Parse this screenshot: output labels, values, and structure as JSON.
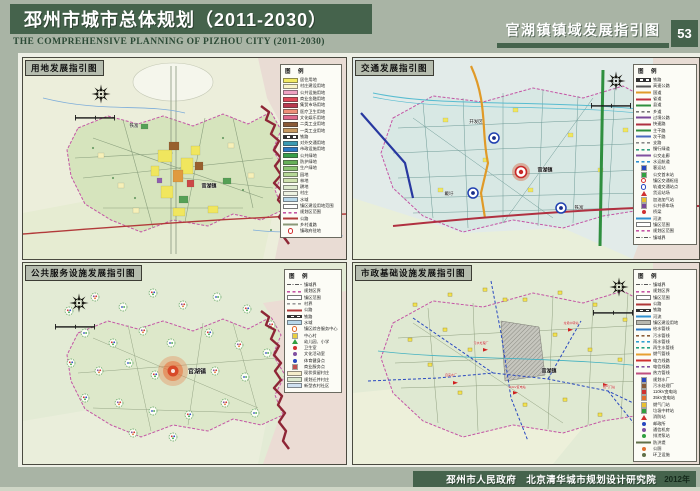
{
  "header": {
    "title_cn": "邳州市城市总体规划（2011-2030）",
    "title_en": "THE  COMPREHENSIVE PLANNING OF PIZHOU CITY  (2011-2030)",
    "sheet_title": "官湖镇镇域发展指引图",
    "page_number": "53"
  },
  "footer": {
    "text": "邳州市人民政府　北京清华城市规划设计研究院",
    "year": "2012年"
  },
  "legend_title": "图 例",
  "colors": {
    "header_green": "#45634c",
    "page_bg": "#a9b4a5",
    "boundary_dark_red": "#8e2636",
    "planning_area_magenta": "#c455a5"
  },
  "panels": [
    {
      "id": "landuse",
      "title": "用地发展指引图",
      "map_labels": [
        {
          "text": "铁富",
          "x": 111,
          "y": 68,
          "size": 4.5
        },
        {
          "text": "官湖镇",
          "x": 186,
          "y": 128,
          "size": 5,
          "bold": true
        }
      ],
      "legend": [
        {
          "type": "fill",
          "color": "#f2ea62",
          "label": "居住用地"
        },
        {
          "type": "fill",
          "color": "#f8f3c6",
          "label": "村庄建设用地"
        },
        {
          "type": "fill",
          "color": "#f0a2c2",
          "label": "公共设施用地"
        },
        {
          "type": "fill",
          "color": "#e04858",
          "label": "商业金融用地"
        },
        {
          "type": "fill",
          "color": "#b93a4e",
          "label": "集贸市场用地"
        },
        {
          "type": "fill",
          "color": "#f09078",
          "label": "医疗卫生用地"
        },
        {
          "type": "fill",
          "color": "#e06a8c",
          "label": "文化娱乐用地"
        },
        {
          "type": "fill",
          "color": "#8a5a36",
          "label": "二类工业用地"
        },
        {
          "type": "fill",
          "color": "#c79a60",
          "label": "一类工业用地"
        },
        {
          "type": "rail",
          "color": "#3a52a8",
          "label": "铁路"
        },
        {
          "type": "fill",
          "color": "#3a9ab2",
          "label": "对外交通用地"
        },
        {
          "type": "fill",
          "color": "#2a78c4",
          "label": "市政设施用地"
        },
        {
          "type": "fill",
          "color": "#389e48",
          "label": "公共绿地"
        },
        {
          "type": "fill",
          "color": "#66b058",
          "label": "防护绿地"
        },
        {
          "type": "fill",
          "color": "#8cc472",
          "label": "生产绿地"
        },
        {
          "type": "fill",
          "color": "#b6d896",
          "label": "园地"
        },
        {
          "type": "fill",
          "color": "#cfe2ae",
          "label": "林地"
        },
        {
          "type": "fill",
          "color": "#deeace",
          "label": "耕地"
        },
        {
          "type": "fill",
          "color": "#eef2e2",
          "label": "村庄"
        },
        {
          "type": "fill",
          "color": "#b8d8ea",
          "label": "水域"
        },
        {
          "type": "outline",
          "color": "#777777",
          "label": "镇区建设用地范围"
        },
        {
          "type": "dash",
          "color": "#c455a5",
          "label": "规划区范围"
        },
        {
          "type": "line",
          "color": "#b03838",
          "label": "公路"
        },
        {
          "type": "line",
          "color": "#8a9878",
          "label": "乡村道路"
        },
        {
          "type": "ring",
          "color": "#d03030",
          "label": "镇政府驻地"
        }
      ]
    },
    {
      "id": "traffic",
      "title": "交通发展指引图",
      "map_labels": [
        {
          "text": "开发区",
          "x": 123,
          "y": 64,
          "size": 4.5
        },
        {
          "text": "官湖镇",
          "x": 192,
          "y": 112,
          "size": 5,
          "bold": true
        },
        {
          "text": "戴圩",
          "x": 96,
          "y": 136,
          "size": 4.5
        },
        {
          "text": "铁富",
          "x": 226,
          "y": 150,
          "size": 4.5
        }
      ],
      "legend": [
        {
          "type": "rail",
          "color": "#333333",
          "label": "铁路"
        },
        {
          "type": "line",
          "color": "#555555",
          "label": "高速公路"
        },
        {
          "type": "line",
          "color": "#e09a28",
          "label": "国道"
        },
        {
          "type": "line",
          "color": "#c03040",
          "label": "省道"
        },
        {
          "type": "line",
          "color": "#2f8f3f",
          "label": "县道"
        },
        {
          "type": "dash",
          "color": "#777777",
          "label": "乡道"
        },
        {
          "type": "line",
          "color": "#7a4898",
          "label": "过境公路"
        },
        {
          "type": "line",
          "color": "#b03040",
          "label": "快速路"
        },
        {
          "type": "line",
          "color": "#2f8f3f",
          "label": "主干路"
        },
        {
          "type": "line",
          "color": "#4a6ac0",
          "label": "次干路"
        },
        {
          "type": "dash",
          "color": "#888888",
          "label": "支路"
        },
        {
          "type": "dash",
          "color": "#30a080",
          "label": "慢行绿道"
        },
        {
          "type": "line",
          "color": "#8050a0",
          "label": "公交走廊"
        },
        {
          "type": "dash",
          "color": "#3090d0",
          "label": "水运航道"
        },
        {
          "type": "sq",
          "color": "#2848c0",
          "label": "客运站"
        },
        {
          "type": "sq",
          "color": "#30a040",
          "label": "公交首末站"
        },
        {
          "type": "ring",
          "color": "#d03030",
          "label": "镇区交通枢纽"
        },
        {
          "type": "ring",
          "color": "#2848c0",
          "label": "轨道交通站点"
        },
        {
          "type": "tri",
          "color": "#d03030",
          "label": "货运站场"
        },
        {
          "type": "sq",
          "color": "#e8c030",
          "label": "加油加气站"
        },
        {
          "type": "sq",
          "color": "#7a4898",
          "label": "公共停车场"
        },
        {
          "type": "dot",
          "color": "#d03030",
          "label": "桥梁"
        },
        {
          "type": "line",
          "color": "#3090d0",
          "label": "河流"
        },
        {
          "type": "outline",
          "color": "#777777",
          "label": "镇区范围"
        },
        {
          "type": "dash",
          "color": "#c455a5",
          "label": "规划区范围"
        },
        {
          "type": "dashdot",
          "color": "#555555",
          "label": "镇域界"
        }
      ]
    },
    {
      "id": "public-services",
      "title": "公共服务设施发展指引图",
      "map_labels": [
        {
          "text": "官湖镇",
          "x": 174,
          "y": 108,
          "size": 6,
          "bold": true
        }
      ],
      "legend": [
        {
          "type": "dashdot",
          "color": "#555555",
          "label": "镇域界"
        },
        {
          "type": "dash",
          "color": "#c455a5",
          "label": "规划区界"
        },
        {
          "type": "outline",
          "color": "#777777",
          "label": "镇区范围"
        },
        {
          "type": "dash",
          "color": "#999999",
          "label": "村界"
        },
        {
          "type": "line",
          "color": "#b03838",
          "label": "公路"
        },
        {
          "type": "rail",
          "color": "#333333",
          "label": "铁路"
        },
        {
          "type": "fill",
          "color": "#b8d8ea",
          "label": "水域"
        },
        {
          "type": "ring",
          "color": "#e06828",
          "label": "镇区综合服务中心"
        },
        {
          "type": "sq",
          "color": "#e8d040",
          "label": "中心村"
        },
        {
          "type": "tri",
          "color": "#30a040",
          "label": "幼儿园、小学"
        },
        {
          "type": "dot",
          "color": "#d03030",
          "label": "卫生室"
        },
        {
          "type": "dot",
          "color": "#8050a0",
          "label": "文化活动室"
        },
        {
          "type": "dot",
          "color": "#2848c0",
          "label": "体育健身点"
        },
        {
          "type": "sq",
          "color": "#c05050",
          "label": "商业服务点"
        },
        {
          "type": "fill",
          "color": "#f5eecb",
          "label": "现状保留村庄"
        },
        {
          "type": "fill",
          "color": "#dcead0",
          "label": "规划迁并村庄"
        },
        {
          "type": "fill",
          "color": "#cfe0f0",
          "label": "新型农村社区"
        }
      ]
    },
    {
      "id": "municipal",
      "title": "市政基础设施发展指引图",
      "map_labels": [
        {
          "text": "官湖镇",
          "x": 196,
          "y": 108,
          "size": 5,
          "bold": true
        },
        {
          "text": "污水处理厂",
          "x": 128,
          "y": 80,
          "size": 3,
          "color": "#c02020"
        },
        {
          "text": "自来水厂",
          "x": 98,
          "y": 112,
          "size": 3,
          "color": "#c02020"
        },
        {
          "text": "110kV变电站",
          "x": 164,
          "y": 124,
          "size": 3,
          "color": "#c02020"
        },
        {
          "text": "垃圾中转站",
          "x": 218,
          "y": 60,
          "size": 3,
          "color": "#c02020"
        },
        {
          "text": "燃气门站",
          "x": 256,
          "y": 124,
          "size": 3,
          "color": "#c02020"
        }
      ],
      "legend": [
        {
          "type": "dashdot",
          "color": "#555555",
          "label": "镇域界"
        },
        {
          "type": "dash",
          "color": "#c455a5",
          "label": "规划区界"
        },
        {
          "type": "outline",
          "color": "#777777",
          "label": "镇区范围"
        },
        {
          "type": "line",
          "color": "#b03838",
          "label": "公路"
        },
        {
          "type": "rail",
          "color": "#333333",
          "label": "铁路"
        },
        {
          "type": "line",
          "color": "#3090d0",
          "label": "河流"
        },
        {
          "type": "fill",
          "color": "#b8b8b0",
          "label": "镇区建设用地"
        },
        {
          "type": "line",
          "color": "#2a78c4",
          "label": "给水管线"
        },
        {
          "type": "dash",
          "color": "#8a5c38",
          "label": "污水管线"
        },
        {
          "type": "dash",
          "color": "#30a0d0",
          "label": "雨水管线"
        },
        {
          "type": "dash",
          "color": "#20a080",
          "label": "再生水管线"
        },
        {
          "type": "line",
          "color": "#e8a030",
          "label": "燃气管线"
        },
        {
          "type": "line",
          "color": "#d03030",
          "label": "电力线路"
        },
        {
          "type": "dash",
          "color": "#8050a0",
          "label": "电信线路"
        },
        {
          "type": "line",
          "color": "#c05080",
          "label": "热力管线"
        },
        {
          "type": "sq",
          "color": "#2848c0",
          "label": "规划水厂"
        },
        {
          "type": "sq",
          "color": "#8a5c38",
          "label": "污水处理厂"
        },
        {
          "type": "sq",
          "color": "#d03030",
          "label": "110kV变电站"
        },
        {
          "type": "sq",
          "color": "#e07030",
          "label": "35kV变电站"
        },
        {
          "type": "sq",
          "color": "#e8c030",
          "label": "燃气门站"
        },
        {
          "type": "sq",
          "color": "#30a040",
          "label": "垃圾中转站"
        },
        {
          "type": "tri",
          "color": "#d03030",
          "label": "消防站"
        },
        {
          "type": "dot",
          "color": "#2848c0",
          "label": "邮政所"
        },
        {
          "type": "dot",
          "color": "#8050a0",
          "label": "通信机房"
        },
        {
          "type": "dot",
          "color": "#30a040",
          "label": "排涝泵站"
        },
        {
          "type": "line",
          "color": "#607048",
          "label": "防洪堤"
        },
        {
          "type": "dot",
          "color": "#e07030",
          "label": "公厕"
        },
        {
          "type": "dot",
          "color": "#607048",
          "label": "环卫设施"
        }
      ]
    }
  ]
}
